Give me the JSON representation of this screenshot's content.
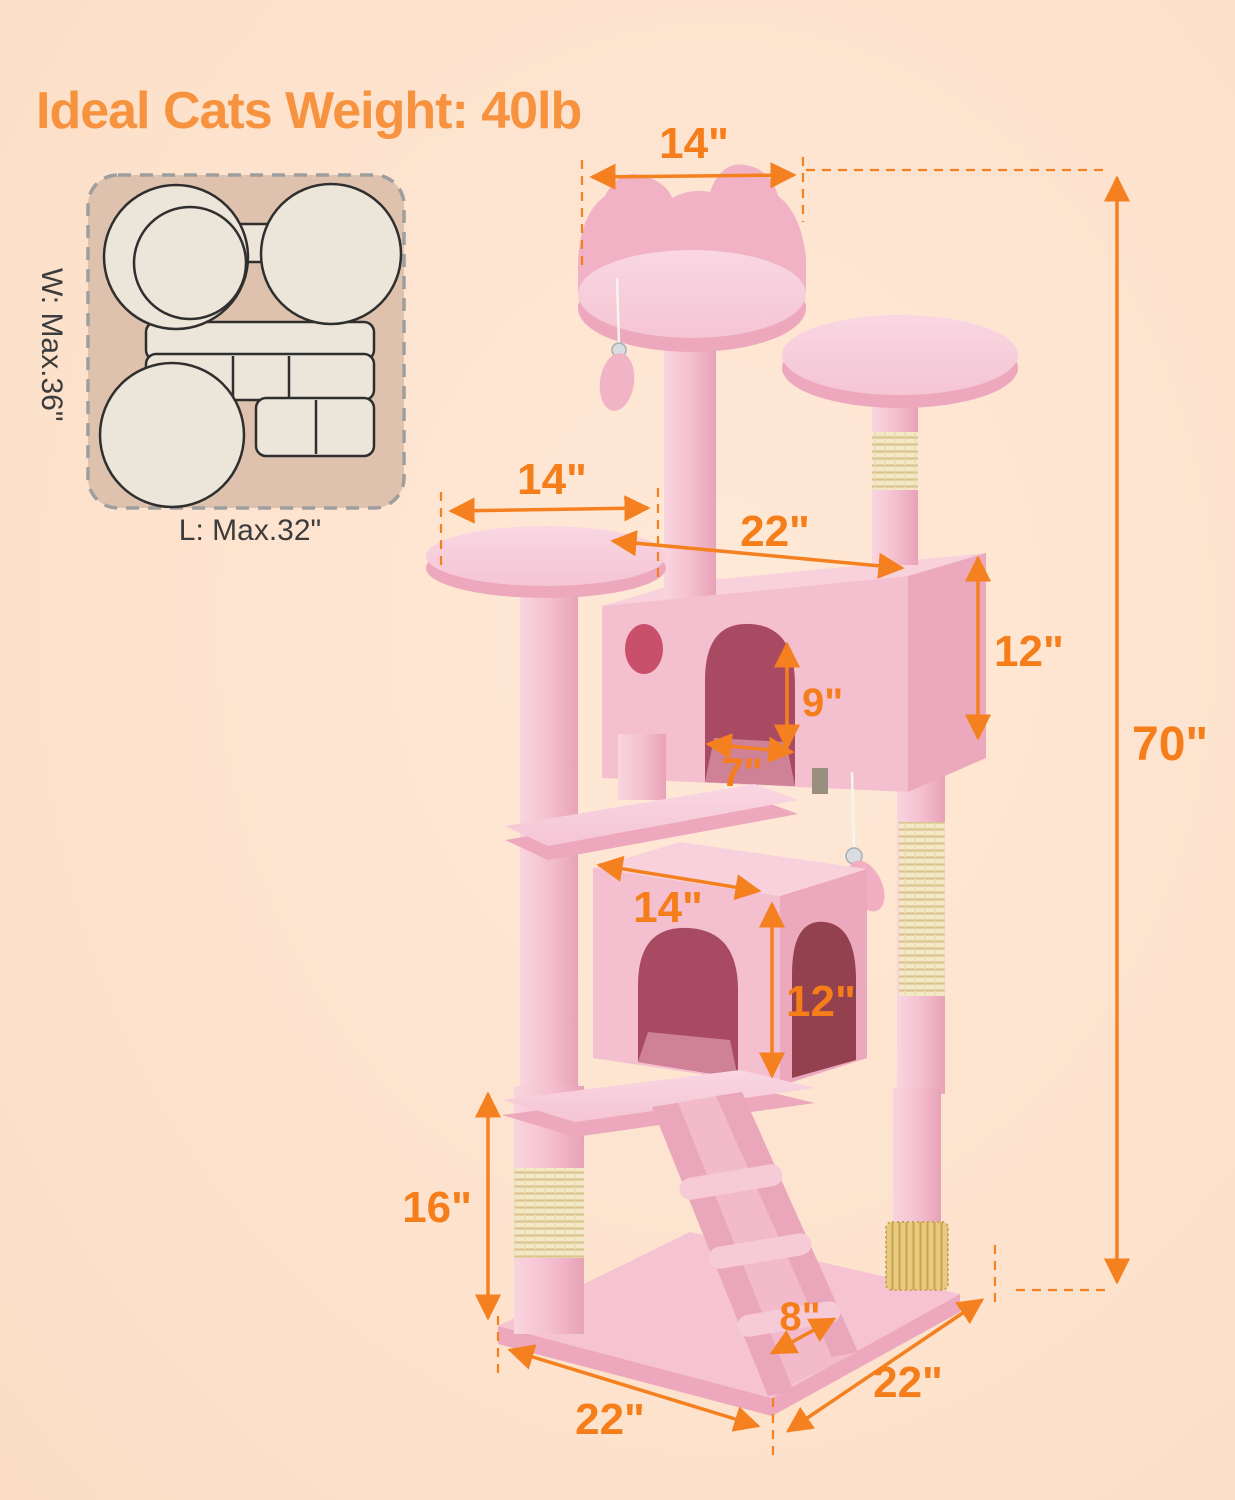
{
  "title": "Ideal Cats Weight: 40lb",
  "inset": {
    "width_label": "W: Max.36\"",
    "length_label": "L: Max.32\""
  },
  "dimensions": {
    "top_perch_width": "14\"",
    "total_height": "70\"",
    "left_platform_width": "14\"",
    "upper_condo_width": "22\"",
    "upper_condo_height": "12\"",
    "upper_opening_height": "9\"",
    "upper_opening_width": "7\"",
    "lower_condo_width": "14\"",
    "lower_condo_height": "12\"",
    "bottom_post_height": "16\"",
    "ladder_width": "8\"",
    "base_edge_front": "22\"",
    "base_edge_right": "22\""
  },
  "colors": {
    "background": "#FCE0C9",
    "accent_orange": "#F5801F",
    "title_orange": "#F7933F",
    "pink_fur": "#F4C0CF",
    "sisal": "#F2E7C2"
  }
}
